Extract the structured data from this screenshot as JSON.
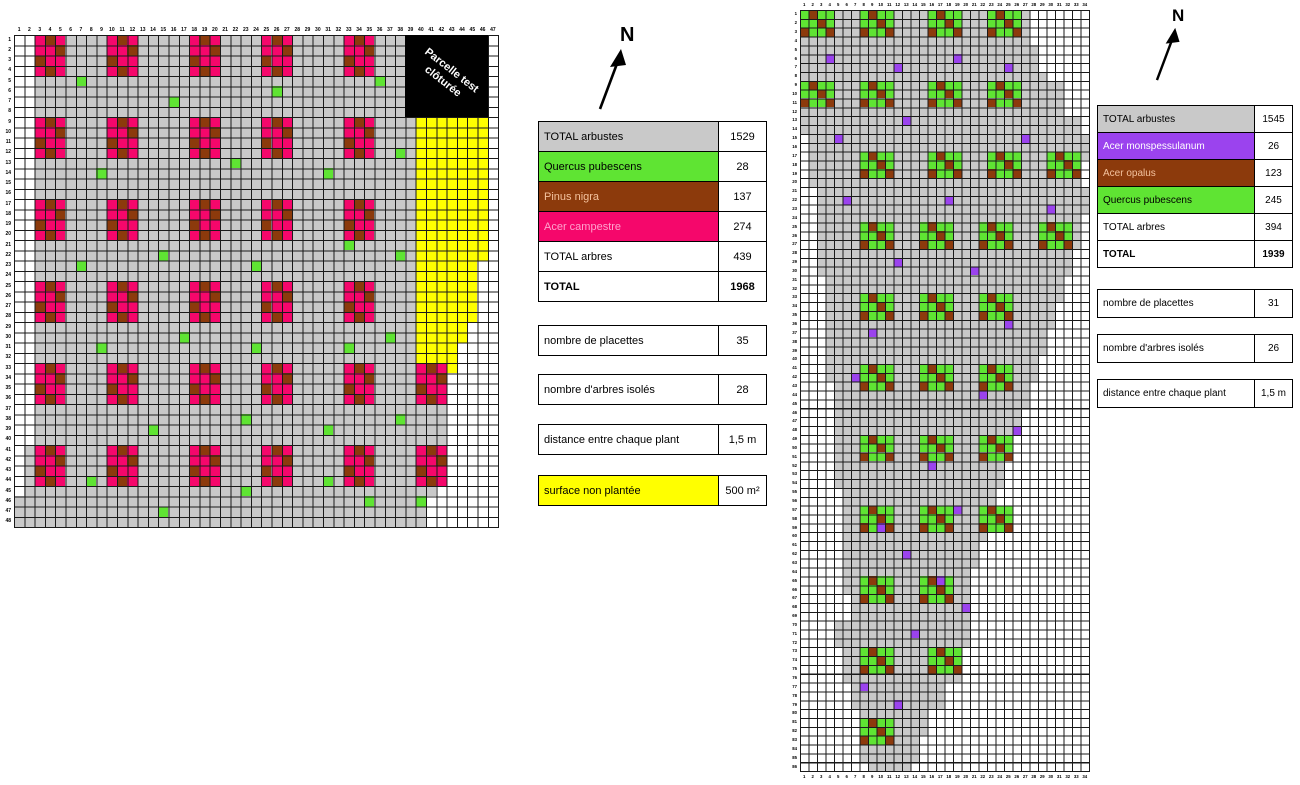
{
  "palette": {
    "gray": "#C9C9C9",
    "yellow": "#FFFF00",
    "pink": "#F5076B",
    "brown": "#8C3A0C",
    "green": "#5FE433",
    "purple": "#9B43EE",
    "grid_line": "#1A1A1A",
    "black": "#000000"
  },
  "north": {
    "label": "N"
  },
  "left_map": {
    "col_count": 47,
    "row_count": 48,
    "fence_box": {
      "label": "Parcelle test clôturée",
      "col_from": 39,
      "col_to": 46,
      "row_from": 1,
      "row_to": 8
    },
    "gray_ranges": [
      [
        1,
        8,
        3,
        38
      ],
      [
        9,
        33,
        3,
        39
      ],
      [
        34,
        40,
        3,
        42
      ],
      [
        41,
        45,
        2,
        41
      ],
      [
        46,
        48,
        1,
        40
      ]
    ],
    "yellow_ranges": [
      [
        9,
        22,
        40,
        46
      ],
      [
        23,
        28,
        40,
        45
      ],
      [
        29,
        30,
        40,
        44
      ],
      [
        31,
        33,
        40,
        43
      ]
    ],
    "cluster_pattern": [
      "aba",
      "aab",
      "baa",
      "aba"
    ],
    "cluster_colors": {
      "a": "pink",
      "b": "brown"
    },
    "clusters": [
      [
        3,
        1
      ],
      [
        10,
        1
      ],
      [
        18,
        1
      ],
      [
        25,
        1
      ],
      [
        33,
        1
      ],
      [
        3,
        9
      ],
      [
        10,
        9
      ],
      [
        18,
        9
      ],
      [
        25,
        9
      ],
      [
        33,
        9
      ],
      [
        3,
        17
      ],
      [
        10,
        17
      ],
      [
        18,
        17
      ],
      [
        25,
        17
      ],
      [
        33,
        17
      ],
      [
        3,
        25
      ],
      [
        10,
        25
      ],
      [
        18,
        25
      ],
      [
        25,
        25
      ],
      [
        33,
        25
      ],
      [
        3,
        33
      ],
      [
        10,
        33
      ],
      [
        18,
        33
      ],
      [
        25,
        33
      ],
      [
        33,
        33
      ],
      [
        40,
        33
      ],
      [
        3,
        41
      ],
      [
        10,
        41
      ],
      [
        18,
        41
      ],
      [
        25,
        41
      ],
      [
        33,
        41
      ],
      [
        40,
        41
      ]
    ],
    "isolated_color": "green",
    "isolated": [
      [
        7,
        5
      ],
      [
        16,
        7
      ],
      [
        26,
        6
      ],
      [
        36,
        5
      ],
      [
        9,
        14
      ],
      [
        22,
        13
      ],
      [
        31,
        14
      ],
      [
        38,
        12
      ],
      [
        7,
        23
      ],
      [
        15,
        22
      ],
      [
        24,
        23
      ],
      [
        33,
        21
      ],
      [
        38,
        22
      ],
      [
        9,
        31
      ],
      [
        17,
        30
      ],
      [
        24,
        31
      ],
      [
        33,
        31
      ],
      [
        37,
        30
      ],
      [
        14,
        39
      ],
      [
        23,
        38
      ],
      [
        31,
        39
      ],
      [
        38,
        38
      ],
      [
        8,
        44
      ],
      [
        23,
        45
      ],
      [
        31,
        44
      ],
      [
        40,
        46
      ],
      [
        15,
        47
      ],
      [
        35,
        46
      ]
    ]
  },
  "right_map": {
    "col_count": 34,
    "row_count": 86,
    "gray_ranges": [
      [
        1,
        4,
        1,
        27
      ],
      [
        5,
        7,
        1,
        28
      ],
      [
        8,
        8,
        1,
        29
      ],
      [
        9,
        12,
        1,
        31
      ],
      [
        13,
        14,
        1,
        33
      ],
      [
        15,
        17,
        2,
        34
      ],
      [
        18,
        20,
        2,
        33
      ],
      [
        21,
        23,
        3,
        34
      ],
      [
        24,
        27,
        3,
        33
      ],
      [
        28,
        30,
        3,
        32
      ],
      [
        31,
        33,
        4,
        31
      ],
      [
        34,
        36,
        4,
        30
      ],
      [
        37,
        39,
        4,
        29
      ],
      [
        40,
        42,
        4,
        28
      ],
      [
        43,
        45,
        5,
        27
      ],
      [
        46,
        48,
        5,
        26
      ],
      [
        49,
        51,
        5,
        25
      ],
      [
        52,
        54,
        5,
        24
      ],
      [
        55,
        57,
        6,
        23
      ],
      [
        58,
        60,
        6,
        22
      ],
      [
        61,
        63,
        6,
        21
      ],
      [
        64,
        66,
        6,
        20
      ],
      [
        67,
        69,
        7,
        20
      ],
      [
        70,
        72,
        5,
        20
      ],
      [
        73,
        76,
        6,
        19
      ],
      [
        77,
        79,
        7,
        17
      ],
      [
        80,
        82,
        8,
        15
      ],
      [
        83,
        85,
        8,
        14
      ],
      [
        86,
        86,
        9,
        13
      ]
    ],
    "cluster_pattern": [
      "abaa",
      "aaba",
      "baab"
    ],
    "cluster_colors": {
      "a": "green",
      "b": "brown"
    },
    "clusters": [
      [
        1,
        1
      ],
      [
        8,
        1
      ],
      [
        16,
        1
      ],
      [
        23,
        1
      ],
      [
        1,
        9
      ],
      [
        8,
        9
      ],
      [
        16,
        9
      ],
      [
        23,
        9
      ],
      [
        8,
        17
      ],
      [
        16,
        17
      ],
      [
        23,
        17
      ],
      [
        30,
        17
      ],
      [
        8,
        25
      ],
      [
        15,
        25
      ],
      [
        22,
        25
      ],
      [
        29,
        25
      ],
      [
        8,
        33
      ],
      [
        15,
        33
      ],
      [
        22,
        33
      ],
      [
        8,
        41
      ],
      [
        15,
        41
      ],
      [
        22,
        41
      ],
      [
        8,
        49
      ],
      [
        15,
        49
      ],
      [
        22,
        49
      ],
      [
        8,
        57
      ],
      [
        15,
        57
      ],
      [
        22,
        57
      ],
      [
        8,
        65
      ],
      [
        15,
        65
      ],
      [
        8,
        73
      ],
      [
        16,
        73
      ],
      [
        8,
        81
      ]
    ],
    "isolated_color": "purple",
    "isolated": [
      [
        4,
        6
      ],
      [
        19,
        6
      ],
      [
        12,
        7
      ],
      [
        25,
        7
      ],
      [
        13,
        13
      ],
      [
        5,
        15
      ],
      [
        27,
        15
      ],
      [
        6,
        22
      ],
      [
        18,
        22
      ],
      [
        30,
        23
      ],
      [
        12,
        29
      ],
      [
        21,
        30
      ],
      [
        25,
        36
      ],
      [
        9,
        37
      ],
      [
        7,
        42
      ],
      [
        22,
        44
      ],
      [
        26,
        48
      ],
      [
        16,
        52
      ],
      [
        10,
        59
      ],
      [
        19,
        57
      ],
      [
        13,
        62
      ],
      [
        17,
        65
      ],
      [
        20,
        68
      ],
      [
        14,
        71
      ],
      [
        8,
        77
      ],
      [
        12,
        79
      ]
    ]
  },
  "legend_left": {
    "rows": [
      {
        "label": "TOTAL arbustes",
        "value": "1529",
        "bg": "gray",
        "fg": "#000000"
      },
      {
        "label": "Quercus pubescens",
        "value": "28",
        "bg": "green",
        "fg": "#000000"
      },
      {
        "label": "Pinus nigra",
        "value": "137",
        "bg": "brown",
        "fg": "#F4C29E"
      },
      {
        "label": "Acer campestre",
        "value": "274",
        "bg": "pink",
        "fg": "#FFA3CE"
      },
      {
        "label": "TOTAL arbres",
        "value": "439",
        "bg": "#FFFFFF",
        "fg": "#000000"
      },
      {
        "label": "TOTAL",
        "value": "1968",
        "bg": "#FFFFFF",
        "fg": "#000000",
        "bold": true
      }
    ],
    "extras": [
      {
        "label": "nombre de placettes",
        "value": "35"
      },
      {
        "label": "nombre d'arbres isolés",
        "value": "28"
      },
      {
        "label": "distance entre chaque plant",
        "value": "1,5 m"
      },
      {
        "label": "surface non plantée",
        "value": "500 m²",
        "label_bg": "yellow"
      }
    ]
  },
  "legend_right": {
    "rows": [
      {
        "label": "TOTAL arbustes",
        "value": "1545",
        "bg": "gray",
        "fg": "#000000"
      },
      {
        "label": "Acer monspessulanum",
        "value": "26",
        "bg": "purple",
        "fg": "#FFFFFF"
      },
      {
        "label": "Acer opalus",
        "value": "123",
        "bg": "brown",
        "fg": "#F4C29E"
      },
      {
        "label": "Quercus pubescens",
        "value": "245",
        "bg": "green",
        "fg": "#000000"
      },
      {
        "label": "TOTAL arbres",
        "value": "394",
        "bg": "#FFFFFF",
        "fg": "#000000"
      },
      {
        "label": "TOTAL",
        "value": "1939",
        "bg": "#FFFFFF",
        "fg": "#000000",
        "bold": true
      }
    ],
    "extras": [
      {
        "label": "nombre de placettes",
        "value": "31"
      },
      {
        "label": "nombre d'arbres isolés",
        "value": "26"
      },
      {
        "label": "distance entre chaque plant",
        "value": "1,5 m"
      }
    ]
  }
}
